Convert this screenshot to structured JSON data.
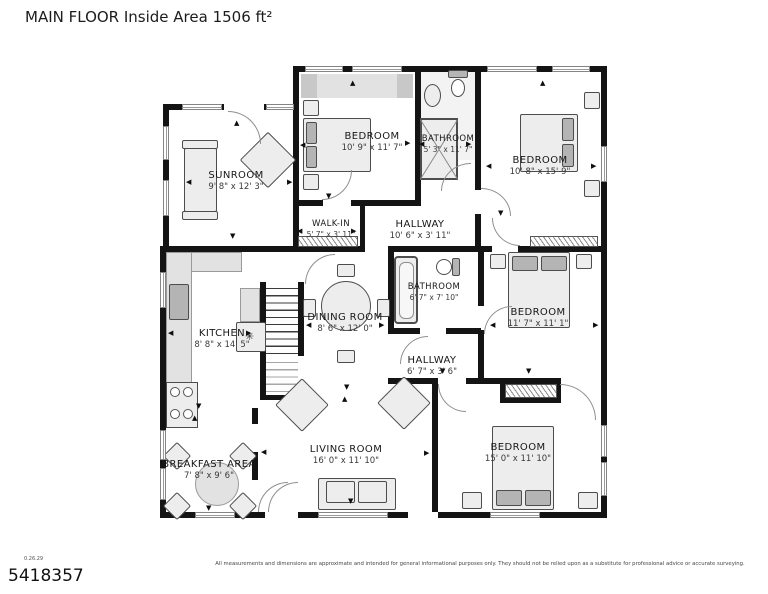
{
  "title": "MAIN FLOOR Inside Area 1506 ft²",
  "rooms": [
    {
      "name": "SUNROOM",
      "dims": "9' 8\" x 12' 3\""
    },
    {
      "name": "BEDROOM",
      "dims": "10' 9\" x 11' 7\""
    },
    {
      "name": "BATHROOM",
      "dims": "5' 3\" x 11' 7\""
    },
    {
      "name": "BEDROOM",
      "dims": "10' 8\" x 15' 9\""
    },
    {
      "name": "WALK-IN",
      "dims": "5' 7\" x 3' 11\""
    },
    {
      "name": "HALLWAY",
      "dims": "10' 6\" x 3' 11\""
    },
    {
      "name": "KITCHEN",
      "dims": "8' 8\" x 14' 5\""
    },
    {
      "name": "DINING ROOM",
      "dims": "8' 6\" x 12' 0\""
    },
    {
      "name": "BATHROOM",
      "dims": "6' 7\" x 7' 10\""
    },
    {
      "name": "BEDROOM",
      "dims": "11' 7\" x 11' 1\""
    },
    {
      "name": "HALLWAY",
      "dims": "6' 7\" x 3' 6\""
    },
    {
      "name": "LIVING ROOM",
      "dims": "16' 0\" x 11' 10\""
    },
    {
      "name": "BREAKFAST AREA",
      "dims": "7' 8\" x 9' 6\""
    },
    {
      "name": "BEDROOM",
      "dims": "15' 0\" x 11' 10\""
    }
  ],
  "footer": {
    "version": "0.26.29",
    "listing_id": "5418357",
    "disclaimer": "All measurements and dimensions are approximate and intended for general informational purposes only. They should not be relied upon as a substitute for professional advice or accurate surveying."
  }
}
